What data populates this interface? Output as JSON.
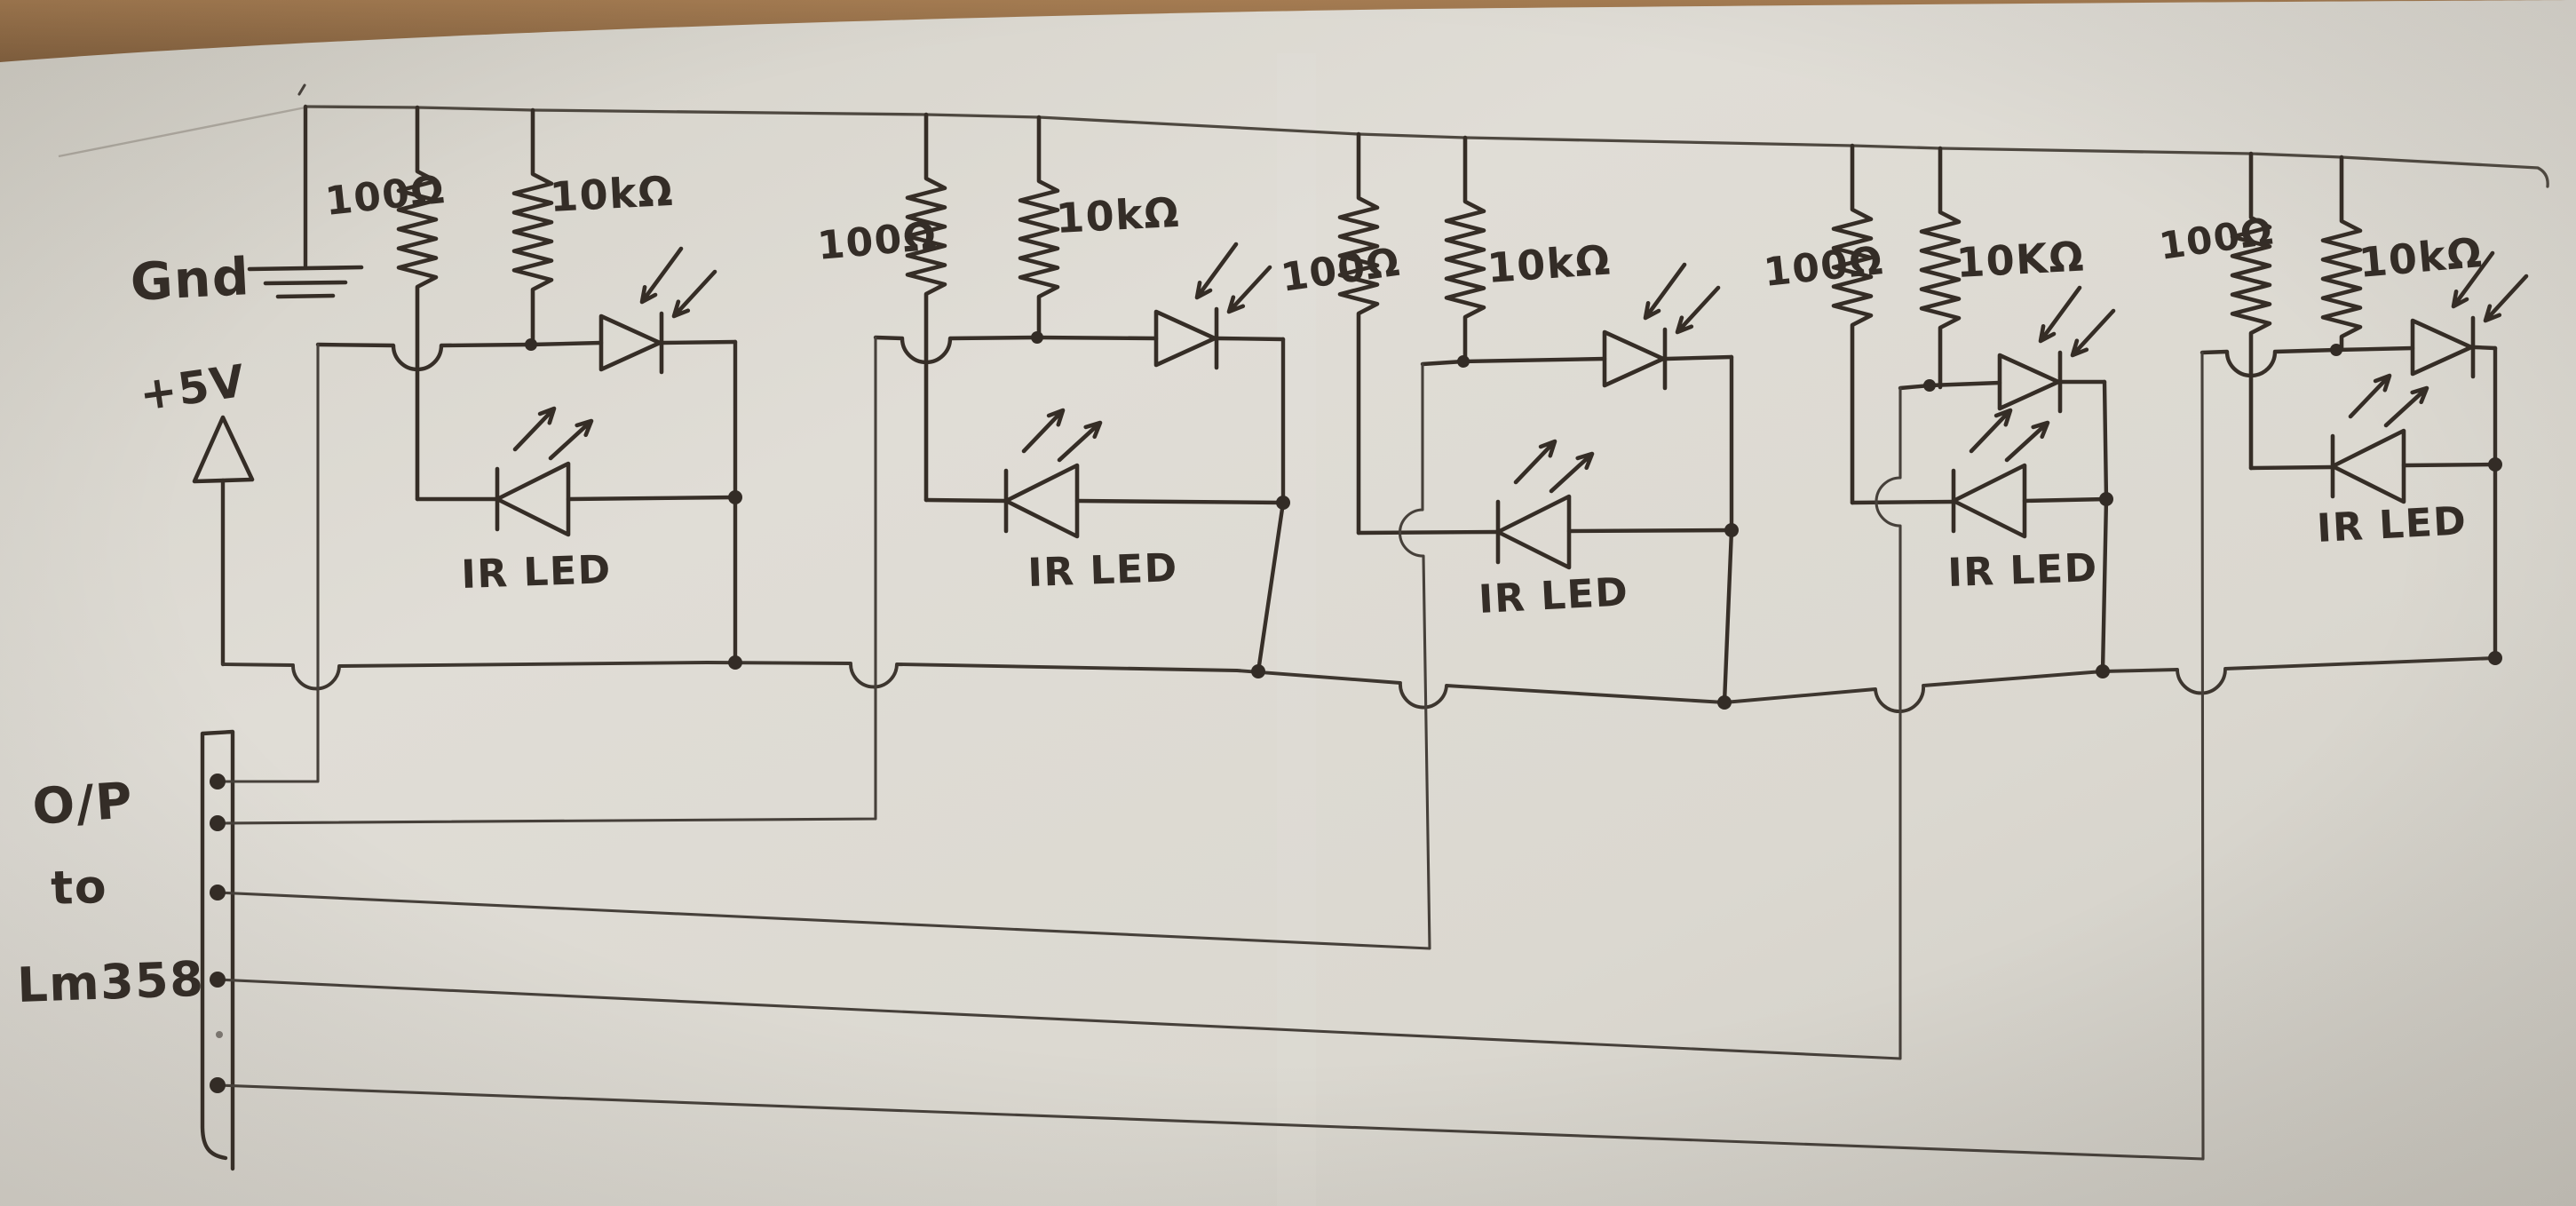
{
  "schematic": {
    "description": "hand-drawn IR LED sensor array schematic",
    "ground_label": "Gnd",
    "supply_label": "+5V",
    "output_label": [
      "O/P",
      "to",
      "Lm358"
    ],
    "modules": [
      {
        "r1_label": "100Ω",
        "r2_label": "10kΩ",
        "led_label": "IR LED"
      },
      {
        "r1_label": "100Ω",
        "r2_label": "10kΩ",
        "led_label": "IR LED"
      },
      {
        "r1_label": "100Ω",
        "r2_label": "10kΩ",
        "led_label": "IR LED"
      },
      {
        "r1_label": "100Ω",
        "r2_label": "10KΩ",
        "led_label": "IR LED"
      },
      {
        "r1_label": "100Ω",
        "r2_label": "10kΩ",
        "led_label": "IR LED"
      }
    ],
    "connector_pins": 5,
    "colors": {
      "ink": "#372f28",
      "paper": "#dcd9d1",
      "wood": "#8a6a48"
    }
  }
}
